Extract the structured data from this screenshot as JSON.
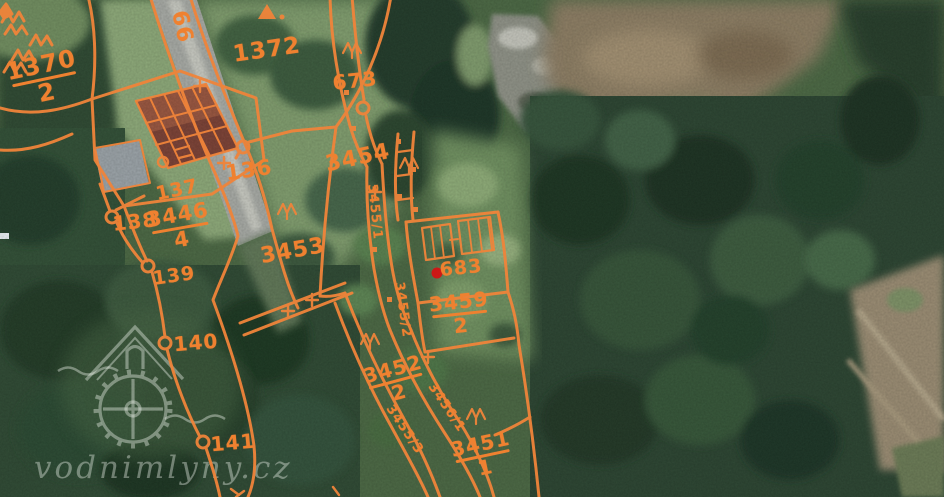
{
  "map": {
    "description": "Cadastral parcel overlay on aerial orthophoto",
    "overlay_color": "#f0843a",
    "label_color": "#ef8130",
    "location_marker_color": "#d31414",
    "watermark": {
      "text": "vodnimlyny.cz",
      "logo": "watermill-house-and-wheel"
    },
    "parcel_labels": [
      {
        "name": "parcel-label-1370-2",
        "num": "1370",
        "den": "2",
        "x": 44,
        "y": 79,
        "rot": -12,
        "size": 24
      },
      {
        "name": "parcel-label-1372",
        "num": "1372",
        "x": 267,
        "y": 51,
        "rot": -8,
        "size": 23
      },
      {
        "name": "road-label-66",
        "num": "66",
        "x": 181,
        "y": 27,
        "rot": 78,
        "size": 22
      },
      {
        "name": "parcel-label-673",
        "num": "673",
        "x": 355,
        "y": 81,
        "rot": -6,
        "size": 20
      },
      {
        "name": "parcel-label-136",
        "num": "136",
        "x": 249,
        "y": 171,
        "rot": -8,
        "size": 21
      },
      {
        "name": "parcel-label-137",
        "num": "137",
        "x": 177,
        "y": 190,
        "rot": -12,
        "size": 19
      },
      {
        "name": "parcel-label-3446-4",
        "num": "3446",
        "den": "4",
        "x": 180,
        "y": 228,
        "rot": -10,
        "size": 21
      },
      {
        "name": "parcel-label-138",
        "num": "138",
        "x": 135,
        "y": 222,
        "rot": -6,
        "size": 20
      },
      {
        "name": "parcel-label-139",
        "num": "139",
        "x": 174,
        "y": 276,
        "rot": -8,
        "size": 19
      },
      {
        "name": "parcel-label-3454",
        "num": "3454",
        "x": 358,
        "y": 159,
        "rot": -12,
        "size": 22
      },
      {
        "name": "parcel-label-3453",
        "num": "3453",
        "x": 293,
        "y": 252,
        "rot": -10,
        "size": 22
      },
      {
        "name": "parcel-label-140",
        "num": "140",
        "x": 196,
        "y": 343,
        "rot": -5,
        "size": 20
      },
      {
        "name": "parcel-label-141",
        "num": "141",
        "x": 233,
        "y": 443,
        "rot": -5,
        "size": 20
      },
      {
        "name": "parcel-label-683",
        "num": "683",
        "x": 461,
        "y": 268,
        "rot": -6,
        "size": 19
      },
      {
        "name": "parcel-label-3459-2",
        "num": "3459",
        "den": "2",
        "x": 460,
        "y": 314,
        "rot": -6,
        "size": 20
      },
      {
        "name": "parcel-label-3452-2",
        "num": "3452",
        "den": "2",
        "x": 396,
        "y": 381,
        "rot": -15,
        "size": 20
      },
      {
        "name": "parcel-label-3451-1",
        "num": "3451",
        "den": "1",
        "x": 483,
        "y": 456,
        "rot": -12,
        "size": 20
      },
      {
        "name": "parcel-label-3455-1",
        "num": "3455/1",
        "x": 374,
        "y": 212,
        "rot": 84,
        "size": 13
      },
      {
        "name": "parcel-label-3455-2",
        "num": "3455/2",
        "x": 402,
        "y": 310,
        "rot": 82,
        "size": 13
      },
      {
        "name": "parcel-label-3455-3",
        "num": "3455/3",
        "x": 404,
        "y": 430,
        "rot": 56,
        "size": 13
      },
      {
        "name": "parcel-label-3456-1",
        "num": "3456/1",
        "x": 446,
        "y": 408,
        "rot": 56,
        "size": 13
      }
    ]
  }
}
